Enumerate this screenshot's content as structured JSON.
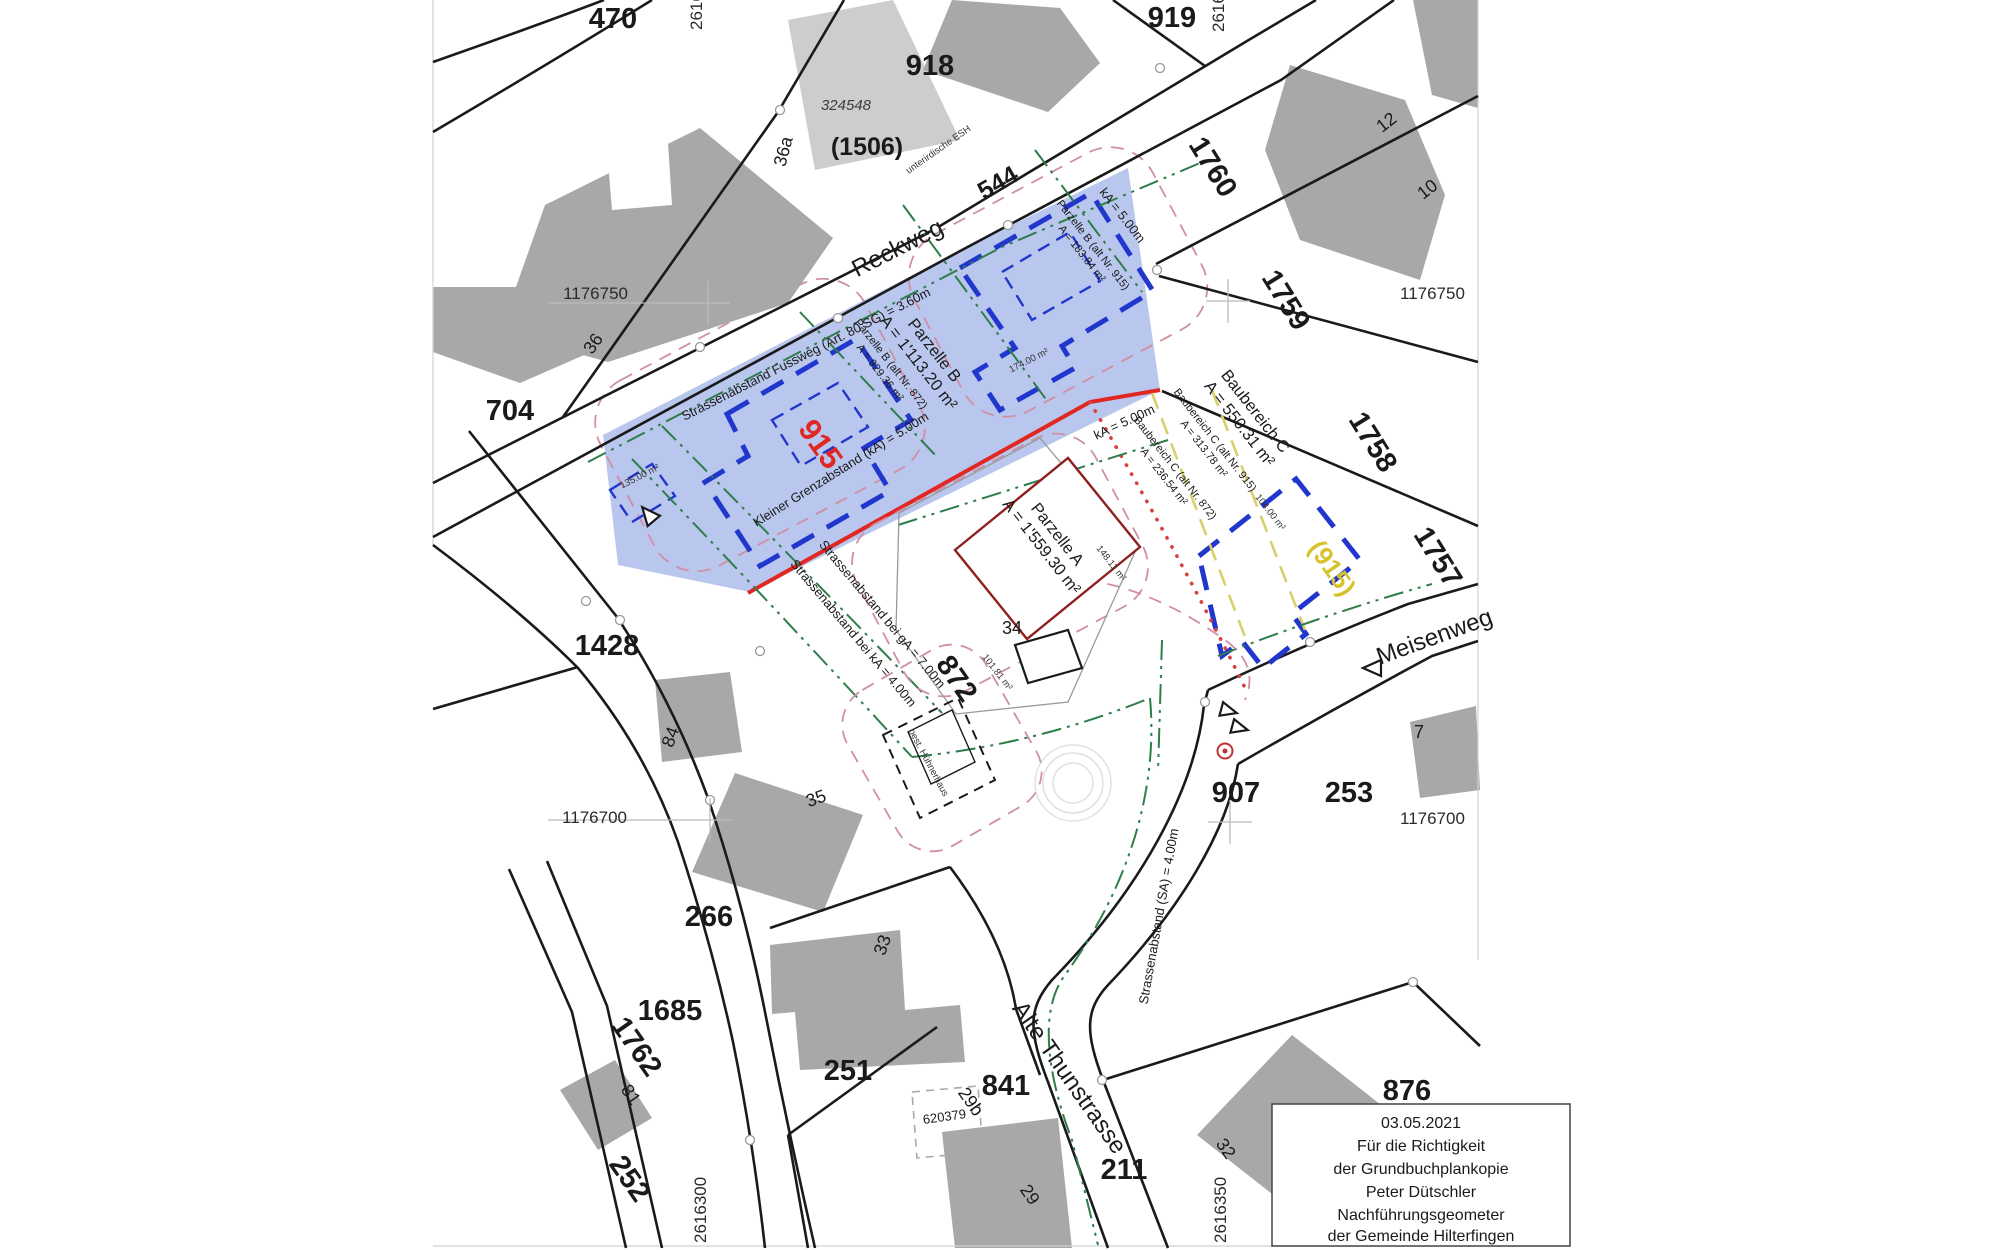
{
  "document": {
    "type": "cadastral-plan-copy",
    "municipality": "Gemeinde Hilterfingen"
  },
  "roads": {
    "reckweg": "Reckweg",
    "alte_thunstrasse": "Alte Thunstrasse",
    "meisenweg": "Meisenweg"
  },
  "parcels": {
    "p470": "470",
    "p704": "704",
    "p918": "918",
    "p919": "919",
    "p1760": "1760",
    "p1759": "1759",
    "p1758": "1758",
    "p1757": "1757",
    "p1428": "1428",
    "p266": "266",
    "p1685": "1685",
    "p251": "251",
    "p841": "841",
    "p211": "211",
    "p252": "252",
    "p1762": "1762",
    "p253": "253",
    "p876": "876",
    "p907": "907",
    "p872": "872",
    "p544": "544",
    "p915_red": "915",
    "p915_yellow": "(915)",
    "p1506": "(1506)",
    "p324548": "324548",
    "p620379": "620379"
  },
  "houses": {
    "h36a": "36a",
    "h36": "36",
    "h12": "12",
    "h10": "10",
    "h84": "84",
    "h35": "35",
    "h33": "33",
    "h34": "34",
    "h81": "81",
    "h29": "29",
    "h29b": "29b",
    "h7": "7",
    "h32": "32"
  },
  "grid": {
    "n750": "1176750",
    "n700": "1176700",
    "e300": "2616300",
    "e350": "2616350"
  },
  "annotations": {
    "strassenabstand_fussweg": "Strassenabstand Fussweg (Art. 80 SG) = 3.60m",
    "parzelle_b_1": "Parzelle B",
    "parzelle_b_2": "A = 1'113.20 m²",
    "parzelle_b_alt872_1": "Parzelle B (alt Nr. 872)",
    "parzelle_b_alt872_2": "A = 929.36 m²",
    "parzelle_b_alt915_1": "Parzelle B (alt Nr. 915)",
    "parzelle_b_alt915_2": "A = 183.84 m²",
    "ka_top": "kA = 5.00m",
    "ka_mid": "kA = 5.00m",
    "kleiner_grenzabstand": "Kleiner Grenzabstand (kA) = 5.00m",
    "baubereich_c_1": "Baubereich C",
    "baubereich_c_2": "A = 550.31 m²",
    "baubereich_c_alt915_1": "Baubereich C (alt Nr. 915)",
    "baubereich_c_alt915_2": "A = 313.78 m²",
    "baubereich_c_alt872_1": "Baubereich C (alt Nr. 872)",
    "baubereich_c_alt872_2": "A = 236.54 m²",
    "parzelle_a_1": "Parzelle A",
    "parzelle_a_2": "A = 1'559.30 m²",
    "sab_ga7": "Strassenabstand bei gA = 7.00m",
    "sab_ka4": "Strassenabstand bei kA = 4.00m",
    "sab_sa4": "Strassenabstand (SA) = 4.00m",
    "best_huehnerhaus": "best. Hühnerhaus",
    "unterirdische_esh": "unterirdische ESH",
    "area_135": "135.00 m²",
    "area_174": "174.00 m²",
    "area_104": "104.00 m²",
    "area_148": "148.11 m²",
    "area_101": "101.81 m²"
  },
  "certification": {
    "date": "03.05.2021",
    "line1": "Für die Richtigkeit",
    "line2": "der Grundbuchplankopie",
    "line3": "Peter Dütschler",
    "line4": "Nachführungsgeometer",
    "line5": "der Gemeinde Hilterfingen"
  },
  "colors": {
    "blue_zone": "#b9c7ee",
    "purple_zone": "#c6b3e0",
    "envelope_fill": "#a8ced9",
    "envelope_stroke": "#2036cc",
    "boundary_red": "#e02722",
    "parcel_915_red": "#e02722",
    "parcel_915_yellow": "#d6c32b",
    "green_setback": "#2e7d4a",
    "building_gray": "#a8a8a8",
    "hall_gray": "#cdcdcd",
    "house_outline_red": "#8e2020",
    "pink_dashed": "#cf8fa5",
    "red_dotted": "#d94040"
  }
}
